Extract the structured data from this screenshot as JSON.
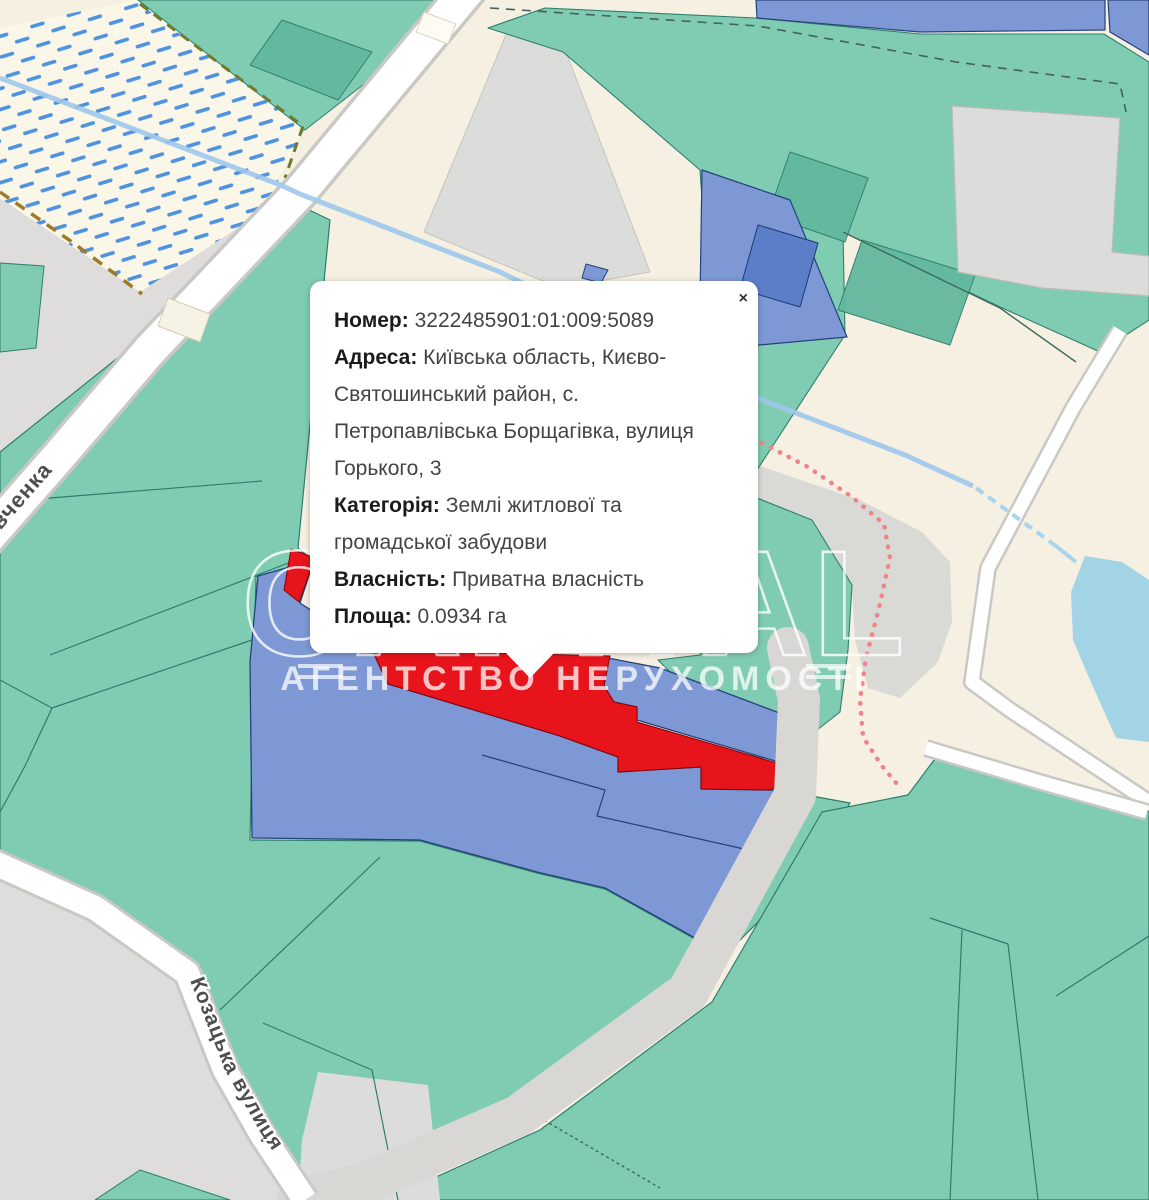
{
  "popup": {
    "close_label": "×",
    "fields": [
      {
        "label": "Номер:",
        "value": " 3222485901:01:009:5089"
      },
      {
        "label": "Адреса:",
        "value": " Київська область, Києво-Святошинський район, с. Петропавлівська Борщагівка, вулиця Горького, 3"
      },
      {
        "label": "Категорія:",
        "value": " Землі житлової та громадської забудови"
      },
      {
        "label": "Власність:",
        "value": " Приватна власність"
      },
      {
        "label": "Площа:",
        "value": " 0.0934 га"
      }
    ]
  },
  "streets": {
    "shevchenka": "вченка",
    "kozatska": "Козацька вулиця"
  },
  "watermark": {
    "the": "THE",
    "brand": "CAPITAL",
    "subtitle": "АГЕНТСТВО НЕРУХОМОСТІ"
  },
  "colors": {
    "selected_parcel": "#e8141c",
    "parcel_blue": "#7d98d5",
    "parcel_green": "#80ccb2",
    "water": "#a3d4e5",
    "road": "#ffffff",
    "base": "#f5f0e1",
    "gray_area": "#dedddb"
  },
  "map": {
    "shapes": [
      {
        "name": "map-background",
        "pts": "0,0 1149,0 1149,1200 0,1200",
        "fill": "#f5f0e1",
        "inter": false
      },
      {
        "name": "gray-area-west",
        "pts": "0,198 140,292 262,212 285,235 40,462 0,462",
        "fill": "#dedddb",
        "inter": false
      },
      {
        "name": "gray-parking-lot",
        "pts": "508,30 566,52 650,272 560,288 424,232",
        "fill": "#dcdcda",
        "stroke": "#c6c4c0",
        "sw": 1,
        "inter": true
      },
      {
        "name": "gray-stadium-area",
        "pts": "757,465 860,500 922,532 950,562 952,622 938,662 900,698 868,688 855,640 852,588 810,522 757,502",
        "fill": "#d9d9d6",
        "inter": false
      },
      {
        "name": "gray-area-southwest",
        "pts": "0,874 90,915 180,975 220,1078 290,1200 0,1200",
        "fill": "#dedddb",
        "inter": false
      },
      {
        "name": "wetland",
        "pts": "0,28 135,0 305,128 262,212 140,292 0,198",
        "fill": "url(#wet)",
        "inter": true
      },
      {
        "name": "green-parcels-main",
        "pts": "0,452 305,208 330,220 298,548 310,558 284,592 256,576 250,840 420,841 537,873 605,889 695,939 758,863 795,793 850,803 812,868 688,992 518,1116 352,1200 303,1200 225,1078 182,975 92,908 0,870",
        "fill": "#80ccb2",
        "stroke": "#2e7d6e",
        "sw": 1.2,
        "inter": true
      },
      {
        "name": "green-parcels-southeast",
        "pts": "908,795 940,752 978,695 1022,722 1149,812 1149,1200 385,1200 540,1130 712,1002 822,812",
        "fill": "#80ccb2",
        "stroke": "#2e7d6e",
        "sw": 1.2,
        "inter": true
      },
      {
        "name": "green-parcel-top",
        "pts": "138,0 462,0 462,8 305,130",
        "fill": "#80ccb2",
        "stroke": "#2e7d6e",
        "sw": 1,
        "inter": true
      },
      {
        "name": "green-parcels-northeast",
        "pts": "488,28 545,8 756,18 920,34 1104,34 1149,62 1149,320 1100,352 1000,307 843,232 845,335 757,470 714,372 700,170 563,52",
        "fill": "#80ccb2",
        "stroke": "#2e7d6e",
        "sw": 1.1,
        "inter": true
      },
      {
        "name": "green-parcel-mid-east",
        "pts": "757,498 812,520 852,585 848,650 840,712 798,745 757,760 700,702 658,660 700,655",
        "fill": "#80ccb2",
        "stroke": "#2e7d6e",
        "sw": 1.1,
        "inter": true
      },
      {
        "name": "green-parcel-in-gray",
        "pts": "0,263 44,266 36,348 0,352",
        "fill": "#80ccb2",
        "stroke": "#2e7d6e",
        "sw": 1,
        "inter": true
      },
      {
        "name": "green-wedge-bottom-left",
        "pts": "95,1200 140,1170 230,1200",
        "fill": "#80ccb2",
        "stroke": "#2e7d6e",
        "sw": 1,
        "inter": true
      },
      {
        "name": "gray-patch-bottom",
        "pts": "318,1072 428,1085 440,1200 298,1200 302,1140",
        "fill": "#dcdcda",
        "inter": false
      },
      {
        "name": "parcel-line",
        "pts": "0,680 52,708 252,640",
        "closed": false,
        "stroke": "#2e7d6e",
        "sw": 1.2,
        "inter": false
      },
      {
        "name": "parcel-line",
        "pts": "0,812 25,766 52,708",
        "closed": false,
        "stroke": "#2e7d6e",
        "sw": 1.2,
        "inter": false
      },
      {
        "name": "parcel-line",
        "pts": "0,502 262,481",
        "closed": false,
        "stroke": "#2e7d6e",
        "sw": 1.2,
        "inter": false
      },
      {
        "name": "parcel-line",
        "pts": "50,655 296,560",
        "closed": false,
        "stroke": "#2e7d6e",
        "sw": 1.2,
        "inter": false
      },
      {
        "name": "parcel-line",
        "pts": "220,1010 380,857",
        "closed": false,
        "stroke": "#2e7d6e",
        "sw": 1.2,
        "inter": false
      },
      {
        "name": "parcel-line",
        "pts": "263,1023 372,1070 398,1200",
        "closed": false,
        "stroke": "#2e7d6e",
        "sw": 1.2,
        "inter": false
      },
      {
        "name": "parcel-line",
        "pts": "930,918 1008,944",
        "closed": false,
        "stroke": "#2e7d6e",
        "sw": 1.2,
        "inter": false
      },
      {
        "name": "parcel-line",
        "pts": "962,930 950,1200",
        "closed": false,
        "stroke": "#2e7d6e",
        "sw": 1.2,
        "inter": false
      },
      {
        "name": "parcel-line",
        "pts": "1008,944 1038,1200",
        "closed": false,
        "stroke": "#2e7d6e",
        "sw": 1.2,
        "inter": false
      },
      {
        "name": "parcel-line",
        "pts": "1056,996 1149,936",
        "closed": false,
        "stroke": "#2e7d6e",
        "sw": 1.2,
        "inter": false
      },
      {
        "name": "parcel-line-hatched",
        "pts": "513,1102 660,1188",
        "closed": false,
        "stroke": "#3a6b5c",
        "sw": 1.4,
        "dash": "3 3",
        "inter": false
      },
      {
        "name": "building-footprint-green",
        "pts": "790,152 868,178 845,242 768,215",
        "fill": "#62b89e",
        "stroke": "#2f7d6a",
        "sw": 1,
        "op": 0.95,
        "inter": false
      },
      {
        "name": "building-footprint-green",
        "pts": "862,240 975,275 950,345 838,310",
        "fill": "#62b89e",
        "stroke": "#2f7d6a",
        "sw": 1,
        "op": 0.95,
        "inter": false
      },
      {
        "name": "building-footprint-green",
        "pts": "282,20 372,52 338,100 250,65",
        "fill": "#62b89e",
        "stroke": "#2f7d6a",
        "sw": 1,
        "op": 0.95,
        "inter": false
      },
      {
        "name": "boundary-dashed-top",
        "pts": "490,8 758,26 956,62 1120,84 1126,112",
        "closed": false,
        "stroke": "#44615a",
        "sw": 1.6,
        "dash": "9 7",
        "inter": false
      },
      {
        "name": "path-dashed-olive",
        "pts": "0,192 72,242 142,294",
        "closed": false,
        "stroke": "#9c7c28",
        "sw": 3.5,
        "dash": "11 8",
        "inter": false
      },
      {
        "name": "path-dashed-olive-green",
        "pts": "140,4 303,126 285,178",
        "closed": false,
        "stroke": "#6f7c2d",
        "sw": 3,
        "dash": "10 7",
        "inter": false
      },
      {
        "name": "boundary-line-ne",
        "pts": "843,232 1000,308 1076,362",
        "closed": false,
        "stroke": "#3e6b5c",
        "sw": 1.4,
        "inter": false
      },
      {
        "name": "gray-parcel-L",
        "pts": "952,106 1120,118 1112,252 1149,256 1149,296 1042,288 958,272",
        "fill": "#dcdcda",
        "stroke": "#bdbbb7",
        "sw": 1.2,
        "inter": true
      },
      {
        "name": "blue-parcel-top-1",
        "pts": "756,0 1105,0 1105,30 920,32 757,18",
        "fill": "#7d98d5",
        "stroke": "#24427c",
        "sw": 1.2,
        "inter": true
      },
      {
        "name": "blue-parcel-top-2",
        "pts": "1108,0 1149,0 1149,55 1110,32",
        "fill": "#7d98d5",
        "stroke": "#24427c",
        "sw": 1.2,
        "inter": true
      },
      {
        "name": "blue-parcel-center-top",
        "pts": "702,170 790,200 847,337 737,347 700,300",
        "fill": "#7d98d5",
        "stroke": "#24427c",
        "sw": 1.2,
        "inter": true
      },
      {
        "name": "building-footprint-blue",
        "pts": "758,225 818,243 800,307 740,289",
        "fill": "#5b7ec9",
        "stroke": "#1d3a70",
        "sw": 1,
        "inter": false
      },
      {
        "name": "blue-parcel-small",
        "pts": "586,264 608,270 601,283 582,278",
        "fill": "#7d98d5",
        "stroke": "#24427c",
        "sw": 1,
        "inter": true
      },
      {
        "name": "blue-parcel-west",
        "pts": "258,576 314,560 300,603 372,650 388,684 560,736 618,757 618,772 701,767 701,789 768,790 795,792 758,862 695,938 605,888 537,872 420,840 252,838 250,662",
        "fill": "#7d98d5",
        "stroke": "#24427c",
        "sw": 1.3,
        "inter": true
      },
      {
        "name": "blue-parcel-northeast",
        "pts": "608,658 660,668 814,726 804,756 792,766 637,720 637,707 614,702 604,686",
        "fill": "#7d98d5",
        "stroke": "#24427c",
        "sw": 1.3,
        "inter": true
      },
      {
        "name": "parcel-line-blue",
        "pts": "482,755 605,790 597,816 753,851",
        "closed": false,
        "stroke": "#24427c",
        "sw": 1.2,
        "inter": false
      },
      {
        "name": "selected-parcel-spike",
        "pts": "291,549 315,558 299,602 284,590",
        "fill": "#e8141c",
        "stroke": "#8c0006",
        "sw": 1,
        "inter": true
      },
      {
        "name": "selected-parcel",
        "pts": "372,650 610,656 604,686 614,702 637,707 637,722 794,768 800,783 768,790 701,789 701,767 618,772 618,757 560,736 388,684",
        "fill": "#e8141c",
        "stroke": "#8c0006",
        "sw": 1,
        "inter": true
      },
      {
        "name": "junction-area",
        "pts": "795,786 973,686 1010,712 1149,802 1147,814 928,752 852,800",
        "fill": "#f5f0e1",
        "inter": false
      },
      {
        "name": "road-corridor-gray",
        "pts": "788,648 799,700 795,795 688,992 518,1116 358,1186 298,1198",
        "closed": false,
        "stroke": "#d8d7d4",
        "sw": 42,
        "cap": "round",
        "inter": false
      },
      {
        "name": "road-shevchenka-casing",
        "pts": "472,-15 300,192 150,350 60,455 -25,552",
        "closed": false,
        "stroke": "#c9c8c5",
        "sw": 40,
        "inter": false
      },
      {
        "name": "road-shevchenka",
        "pts": "472,-15 300,192 150,350 60,455 -25,552",
        "closed": false,
        "stroke": "#ffffff",
        "sw": 33,
        "inter": true
      },
      {
        "name": "road-east-casing",
        "pts": "1120,330 1073,408 988,568 972,682 1010,710 1149,802",
        "closed": false,
        "stroke": "#c9c8c5",
        "sw": 18,
        "inter": false
      },
      {
        "name": "road-east",
        "pts": "1120,330 1073,408 988,568 972,682 1010,710 1149,802",
        "closed": false,
        "stroke": "#ffffff",
        "sw": 13,
        "inter": true
      },
      {
        "name": "road-east-branch-casing",
        "pts": "926,748 1040,782 1147,812",
        "closed": false,
        "stroke": "#c9c8c5",
        "sw": 18,
        "inter": false
      },
      {
        "name": "road-east-branch",
        "pts": "926,748 1040,782 1147,812",
        "closed": false,
        "stroke": "#ffffff",
        "sw": 13,
        "inter": true
      },
      {
        "name": "road-kozatska-casing",
        "pts": "-12,860 95,908 187,973 225,1070 262,1135 305,1200",
        "closed": false,
        "stroke": "#c9c8c5",
        "sw": 30,
        "inter": false
      },
      {
        "name": "road-kozatska",
        "pts": "-12,860 95,908 187,973 225,1070 262,1135 305,1200",
        "closed": false,
        "stroke": "#ffffff",
        "sw": 24,
        "inter": true
      },
      {
        "name": "building-roadside",
        "pts": "424,12 456,24 448,44 416,32",
        "fill": "#fdfbf4",
        "stroke": "#d9d4c4",
        "sw": 1,
        "inter": false
      },
      {
        "name": "building-roadside",
        "pts": "168,298 210,314 200,342 158,326",
        "fill": "#f6f2e6",
        "stroke": "#d8cbb2",
        "sw": 1,
        "inter": false
      },
      {
        "name": "stream",
        "d": "M 0 78 L 283 186 L 300 194 L 500 272 L 757 398 L 905 455 L 973 486",
        "stroke": "#9fc8ec",
        "sw": 5,
        "op": 0.9,
        "inter": false
      },
      {
        "name": "stream-culvert-dashed",
        "pts": "976,488 1056,546",
        "closed": false,
        "stroke": "#a8d4ef",
        "sw": 4,
        "dash": "9 6",
        "inter": false
      },
      {
        "name": "stream-connector",
        "pts": "1056,546 1076,562",
        "closed": false,
        "stroke": "#a8d4ef",
        "sw": 4,
        "inter": false
      },
      {
        "name": "pond",
        "pts": "1085,556 1122,562 1149,580 1149,742 1116,738 1090,680 1073,640 1071,592",
        "fill": "#a3d4e5",
        "inter": true
      },
      {
        "name": "path-dotted-pink",
        "d": "M 762 443 L 808 467 L 852 497 L 884 524 L 890 558 L 879 608 L 866 658 L 860 700 L 863 737 L 882 766 L 902 790",
        "stroke": "#ef8587",
        "sw": 4.5,
        "dash": "0.5 9.5",
        "cap": "round",
        "inter": false
      },
      {
        "name": "watermark-tick",
        "pts": "298,666 343,666",
        "closed": false,
        "stroke": "rgba(255,255,255,0.7)",
        "sw": 4,
        "inter": false
      },
      {
        "name": "watermark-tick",
        "pts": "298,677 343,677",
        "closed": false,
        "stroke": "rgba(255,255,255,0.7)",
        "sw": 4,
        "inter": false
      },
      {
        "name": "watermark-tick",
        "pts": "806,666 851,666",
        "closed": false,
        "stroke": "rgba(255,255,255,0.7)",
        "sw": 4,
        "inter": false
      },
      {
        "name": "watermark-tick",
        "pts": "806,677 851,677",
        "closed": false,
        "stroke": "rgba(255,255,255,0.7)",
        "sw": 4,
        "inter": false
      }
    ]
  }
}
